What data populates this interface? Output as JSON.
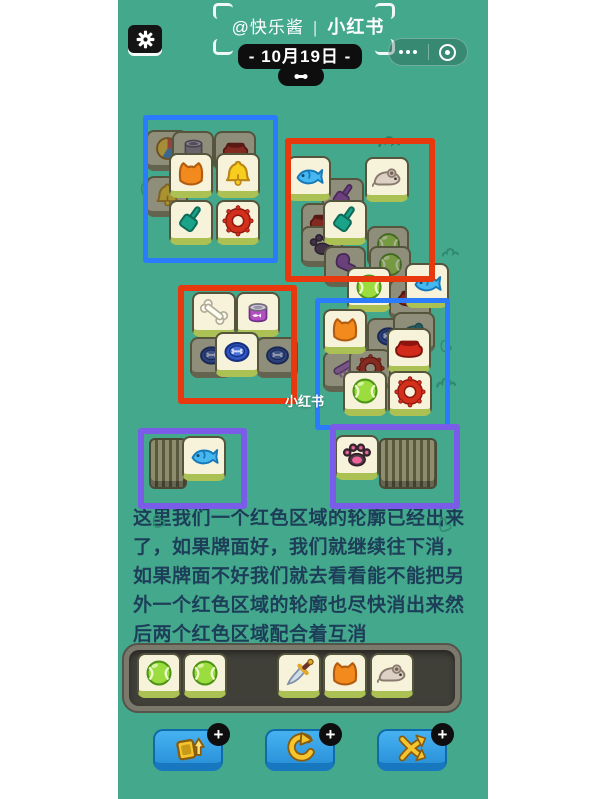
{
  "header": {
    "author": "@快乐酱",
    "separator": "|",
    "brand": "小红书",
    "date": "- 10月19日 -"
  },
  "watermark": "小红书",
  "guide": {
    "lines": [
      "这里我们一个红色区域的轮廓已经出来",
      "了，如果牌面好，我们就继续往下消，",
      "如果牌面不好我们就去看看能不能把另",
      "外一个红色区域的轮廓也尽快消出来然",
      "后两个红色区域配合着互消"
    ]
  },
  "colors": {
    "teal": "#44a88d",
    "ink": "#1d3e58",
    "box_blue": "#2b7bff",
    "box_red": "#e8380d",
    "box_purple": "#7a5ce8",
    "tile_face": "#f6f3da",
    "tile_dark": "#8f8e7b",
    "button_blue": "#35a3e8",
    "icon_yellow": "#f2c21c"
  },
  "board": {
    "boxes": [
      {
        "name": "highlight-box-blue-top-left",
        "color": "#2b7bff",
        "stroke": 5,
        "x": 25,
        "y": 115,
        "w": 125,
        "h": 138
      },
      {
        "name": "highlight-box-red-top-right",
        "color": "#e8380d",
        "stroke": 6,
        "x": 167,
        "y": 138,
        "w": 138,
        "h": 132
      },
      {
        "name": "highlight-box-red-mid-left",
        "color": "#e8380d",
        "stroke": 6,
        "x": 60,
        "y": 285,
        "w": 107,
        "h": 107
      },
      {
        "name": "highlight-box-blue-mid-right",
        "color": "#2b7bff",
        "stroke": 5,
        "x": 197,
        "y": 298,
        "w": 125,
        "h": 122
      },
      {
        "name": "highlight-box-purple-left",
        "color": "#7a5ce8",
        "stroke": 6,
        "x": 20,
        "y": 428,
        "w": 97,
        "h": 69
      },
      {
        "name": "highlight-box-purple-right",
        "color": "#7a5ce8",
        "stroke": 6,
        "x": 212,
        "y": 424,
        "w": 118,
        "h": 73
      }
    ],
    "stacks": [
      {
        "name": "tile-stack-left",
        "x": 31,
        "y": 438,
        "w": 34,
        "h": 47
      },
      {
        "name": "tile-stack-right",
        "x": 261,
        "y": 438,
        "w": 54,
        "h": 47
      }
    ],
    "tiles": [
      {
        "icon": "beachball",
        "variant": "dark",
        "x": 28,
        "y": 130
      },
      {
        "icon": "can",
        "variant": "dark",
        "x": 54,
        "y": 131
      },
      {
        "icon": "bowl",
        "variant": "dark",
        "x": 96,
        "y": 131
      },
      {
        "icon": "bell",
        "variant": "dark",
        "x": 28,
        "y": 176
      },
      {
        "icon": "cat",
        "variant": "bright",
        "x": 51,
        "y": 153
      },
      {
        "icon": "bell",
        "variant": "bright",
        "x": 98,
        "y": 153
      },
      {
        "icon": "shovel",
        "variant": "bright",
        "x": 51,
        "y": 200
      },
      {
        "icon": "ring",
        "variant": "bright",
        "x": 98,
        "y": 200
      },
      {
        "icon": "shovelp",
        "variant": "dark",
        "x": 204,
        "y": 178
      },
      {
        "icon": "bowl",
        "variant": "dark",
        "x": 183,
        "y": 203
      },
      {
        "icon": "paw",
        "variant": "dark",
        "x": 183,
        "y": 226
      },
      {
        "icon": "ball",
        "variant": "dark",
        "x": 249,
        "y": 226
      },
      {
        "icon": "ball",
        "variant": "dark",
        "x": 251,
        "y": 246
      },
      {
        "icon": "glove",
        "variant": "dark",
        "x": 206,
        "y": 246
      },
      {
        "icon": "fish",
        "variant": "bright",
        "x": 169,
        "y": 156
      },
      {
        "icon": "mouse",
        "variant": "bright",
        "x": 247,
        "y": 157
      },
      {
        "icon": "shovel",
        "variant": "bright",
        "x": 205,
        "y": 200
      },
      {
        "icon": "bowl",
        "variant": "dark",
        "x": 271,
        "y": 279
      },
      {
        "icon": "ball",
        "variant": "bright",
        "x": 229,
        "y": 267
      },
      {
        "icon": "fish",
        "variant": "bright",
        "x": 287,
        "y": 263
      },
      {
        "icon": "frisbee",
        "variant": "dark",
        "x": 72,
        "y": 337
      },
      {
        "icon": "frisbee",
        "variant": "dark",
        "x": 138,
        "y": 337
      },
      {
        "icon": "bone",
        "variant": "bright",
        "x": 74,
        "y": 292
      },
      {
        "icon": "catfood",
        "variant": "bright",
        "x": 118,
        "y": 292
      },
      {
        "icon": "frisbee",
        "variant": "bright",
        "x": 97,
        "y": 332
      },
      {
        "icon": "frisbee",
        "variant": "dark",
        "x": 249,
        "y": 318
      },
      {
        "icon": "mouset",
        "variant": "dark",
        "x": 275,
        "y": 312
      },
      {
        "icon": "comb",
        "variant": "dark",
        "x": 205,
        "y": 351
      },
      {
        "icon": "ring",
        "variant": "dark",
        "x": 231,
        "y": 349
      },
      {
        "icon": "cat",
        "variant": "bright",
        "x": 205,
        "y": 309
      },
      {
        "icon": "bowl",
        "variant": "bright",
        "x": 269,
        "y": 328
      },
      {
        "icon": "ball",
        "variant": "bright",
        "x": 225,
        "y": 371
      },
      {
        "icon": "ring",
        "variant": "bright",
        "x": 270,
        "y": 371
      },
      {
        "icon": "fish",
        "variant": "bright",
        "x": 64,
        "y": 436
      },
      {
        "icon": "pawpink",
        "variant": "bright",
        "x": 217,
        "y": 435
      },
      {
        "icon": "ball",
        "variant": "bright",
        "x": 19,
        "y": 653,
        "clickable": false
      },
      {
        "icon": "ball",
        "variant": "bright",
        "x": 65,
        "y": 653,
        "clickable": false
      },
      {
        "icon": "knife",
        "variant": "bright",
        "x": 159,
        "y": 653,
        "clickable": false
      },
      {
        "icon": "cat",
        "variant": "bright",
        "x": 205,
        "y": 653,
        "clickable": false
      },
      {
        "icon": "mouse",
        "variant": "bright",
        "x": 252,
        "y": 653,
        "clickable": false
      }
    ],
    "decorations": [
      {
        "icon": "grass",
        "x": 258,
        "y": 126,
        "size": 28,
        "color": "#2c7f63"
      },
      {
        "icon": "hand",
        "x": 20,
        "y": 180,
        "size": 18,
        "color": "#2f8a6e"
      },
      {
        "icon": "grass",
        "x": 322,
        "y": 240,
        "size": 22,
        "color": "#2f8a6e"
      },
      {
        "icon": "hand",
        "x": 320,
        "y": 338,
        "size": 16,
        "color": "#2f8a6e"
      },
      {
        "icon": "grass",
        "x": 316,
        "y": 368,
        "size": 26,
        "color": "#2f8a6e"
      },
      {
        "icon": "hand",
        "x": 32,
        "y": 512,
        "size": 18,
        "color": "#2f8a6e"
      },
      {
        "icon": "hand",
        "x": 318,
        "y": 516,
        "size": 18,
        "color": "#2f8a6e"
      }
    ]
  },
  "toolbar": {
    "badge": "+",
    "buttons": [
      {
        "name": "moveout-button",
        "icon": "moveout"
      },
      {
        "name": "undo-button",
        "icon": "undo"
      },
      {
        "name": "shuffle-button",
        "icon": "shuffle"
      }
    ]
  }
}
